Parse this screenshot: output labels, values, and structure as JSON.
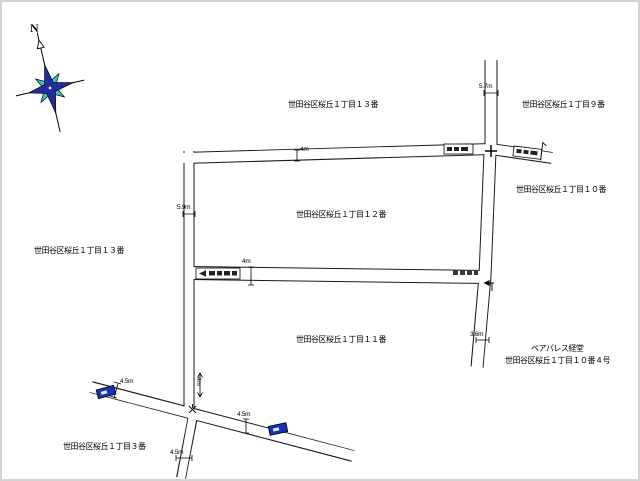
{
  "map": {
    "title": "世田谷区桜丘 街区図",
    "compass": {
      "north_label": "N"
    },
    "area_labels": [
      {
        "id": "block-13-top",
        "text": "世田谷区桜丘１丁目１３番",
        "x": 288,
        "y": 99
      },
      {
        "id": "block-9",
        "text": "世田谷区桜丘１丁目９番",
        "x": 522,
        "y": 99
      },
      {
        "id": "block-10",
        "text": "世田谷区桜丘１丁目１０番",
        "x": 516,
        "y": 184
      },
      {
        "id": "block-12",
        "text": "世田谷区桜丘１丁目１２番",
        "x": 296,
        "y": 209
      },
      {
        "id": "block-13-left",
        "text": "世田谷区桜丘１丁目１３番",
        "x": 34,
        "y": 245
      },
      {
        "id": "block-11",
        "text": "世田谷区桜丘１丁目１１番",
        "x": 296,
        "y": 334
      },
      {
        "id": "building-name",
        "text": "ペアパレス経堂",
        "x": 531,
        "y": 343
      },
      {
        "id": "building-address",
        "text": "世田谷区桜丘１丁目１０番４号",
        "x": 505,
        "y": 355
      },
      {
        "id": "block-3",
        "text": "世田谷区桜丘１丁目３番",
        "x": 63,
        "y": 441
      }
    ],
    "dimension_labels": [
      {
        "id": "w-5-7",
        "text": "5.7m",
        "x": 479,
        "y": 83
      },
      {
        "id": "w-4-top",
        "text": "4m",
        "x": 300,
        "y": 146
      },
      {
        "id": "w-5-9",
        "text": "5.9m",
        "x": 177,
        "y": 204
      },
      {
        "id": "w-4-mid",
        "text": "4m",
        "x": 242,
        "y": 258
      },
      {
        "id": "w-3-6",
        "text": "3.6m",
        "x": 470,
        "y": 331
      },
      {
        "id": "w-4-left",
        "text": "4m",
        "x": 202,
        "y": 377,
        "rot": 90
      },
      {
        "id": "w-4-5-bus",
        "text": "4.5m",
        "x": 120,
        "y": 378
      },
      {
        "id": "w-4-5-diag",
        "text": "4.5m",
        "x": 237,
        "y": 411
      },
      {
        "id": "w-4-5-bot",
        "text": "4.5m",
        "x": 170,
        "y": 449
      }
    ],
    "colors": {
      "road_outline": "#1a1a1a",
      "road_fill": "#ffffff",
      "bus_marker": "#1733b8",
      "compass_primary": "#1f2da0",
      "compass_secondary": "#3ac6c6"
    }
  }
}
